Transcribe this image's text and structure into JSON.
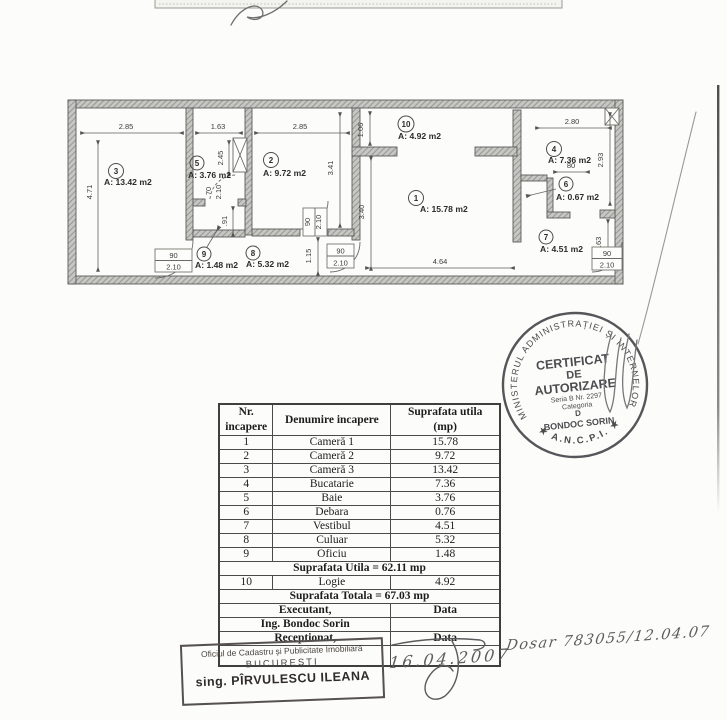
{
  "plan": {
    "rooms": {
      "r1": {
        "no": "1",
        "area": "A: 15.78 m2"
      },
      "r2": {
        "no": "2",
        "area": "A: 9.72 m2"
      },
      "r3": {
        "no": "3",
        "area": "A: 13.42 m2"
      },
      "r4": {
        "no": "4",
        "area": "A: 7.36 m2"
      },
      "r5": {
        "no": "5",
        "area": "A: 3.76 m2"
      },
      "r6": {
        "no": "6",
        "area": "A: 0.67 m2"
      },
      "r7": {
        "no": "7",
        "area": "A: 4.51 m2"
      },
      "r8": {
        "no": "8",
        "area": "A: 5.32 m2"
      },
      "r9": {
        "no": "9",
        "area": "A: 1.48 m2"
      },
      "r10": {
        "no": "10",
        "area": "A: 4.92 m2"
      }
    },
    "dims": {
      "room3_w": "2.85",
      "hall_w": "1.63",
      "room2_w": "2.85",
      "room4_w": "2.80",
      "left_h": "4.71",
      "logie_h": "1.06",
      "bath_h": "2.45",
      "door5_w": "70",
      "door5_h": "2.10",
      "oficiu_h": ".91",
      "room2_h": "3.41",
      "room1_h": "3.40",
      "hall_h": "1.15",
      "room1_w": "4.64",
      "door6_w": "80",
      "room4_h": "2.93",
      "vest_h": "1.63",
      "door_w": "90",
      "door_h": "2.10"
    }
  },
  "table": {
    "header": {
      "col1_line1": "Nr.",
      "col1_line2": "incapere",
      "col2": "Denumire incapere",
      "col3_line1": "Suprafata utila",
      "col3_line2": "(mp)"
    },
    "rows": [
      {
        "nr": "1",
        "name": "Cameră 1",
        "area": "15.78"
      },
      {
        "nr": "2",
        "name": "Cameră 2",
        "area": "9.72"
      },
      {
        "nr": "3",
        "name": "Cameră 3",
        "area": "13.42"
      },
      {
        "nr": "4",
        "name": "Bucatarie",
        "area": "7.36"
      },
      {
        "nr": "5",
        "name": "Baie",
        "area": "3.76"
      },
      {
        "nr": "6",
        "name": "Debara",
        "area": "0.76"
      },
      {
        "nr": "7",
        "name": "Vestibul",
        "area": "4.51"
      },
      {
        "nr": "8",
        "name": "Culuar",
        "area": "5.32"
      },
      {
        "nr": "9",
        "name": "Oficiu",
        "area": "1.48"
      }
    ],
    "summary_utila": "Suprafata Utila = 62.11 mp",
    "row10": {
      "nr": "10",
      "name": "Logie",
      "area": "4.92"
    },
    "summary_totala": "Suprafata Totala = 67.03 mp",
    "executant_label": "Executant,",
    "executant_name": "Ing. Bondoc Sorin",
    "receptionat_label": "Receptionat,",
    "data_label": "Data",
    "data_label2": "Data"
  },
  "round_stamp": {
    "ring_top": "MINISTERUL ADMINISTRAȚIEI ȘI INTERNELOR",
    "ring_bottom": "★ A.N.C.P.I. ★",
    "title1": "CERTIFICAT",
    "title2": "DE",
    "title3": "AUTORIZARE",
    "seria": "Seria B Nr. 2297",
    "categoria": "Categoria",
    "cat_letter": "D",
    "name": "BONDOC SORIN"
  },
  "office_stamp": {
    "line1": "Oficiul de Cadastru și Publicitate Imobiliară",
    "line2": "BUCUREȘTI",
    "line3": "sing. PÎRVULESCU ILEANA"
  },
  "handwritten": {
    "date": "16.04.2007",
    "dosar": "Dosar 783055/12.04.07"
  }
}
